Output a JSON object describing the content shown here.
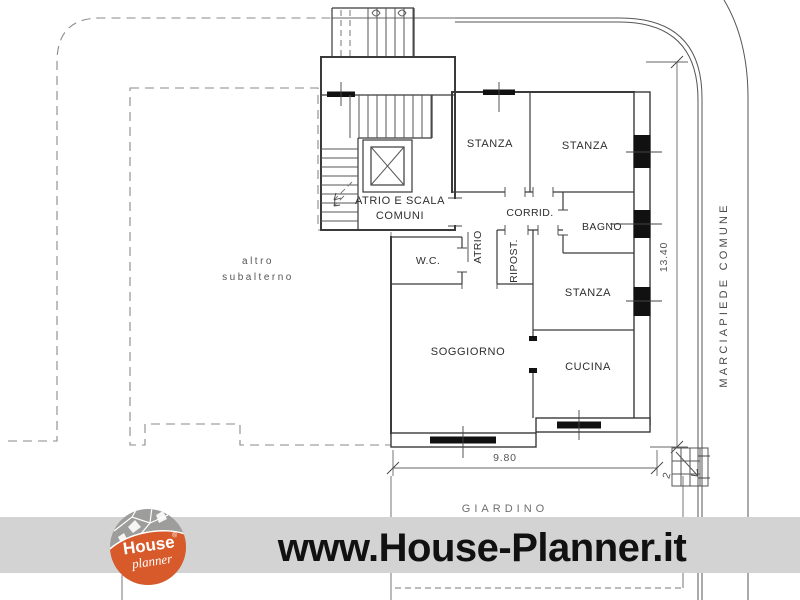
{
  "plan": {
    "room_labels": {
      "atrio_scala_line1": "ATRIO E SCALA",
      "atrio_scala_line2": "COMUNI",
      "stanza_nw": "STANZA",
      "stanza_ne": "STANZA",
      "corridoio": "CORRID.",
      "bagno": "BAGNO",
      "atrio": "ATRIO",
      "ripostiglio": "RIPOST.",
      "wc": "W.C.",
      "stanza_e": "STANZA",
      "soggiorno": "SOGGIORNO",
      "cucina": "CUCINA"
    },
    "area_labels": {
      "altro_line1": "altro",
      "altro_line2": "subalterno",
      "giardino": "GIARDINO",
      "marciapiede": "MARCIAPIEDE COMUNE"
    },
    "dimensions": {
      "vertical": "13.40",
      "horizontal": "9.80",
      "steps": "2"
    }
  },
  "footer": {
    "url": "www.House-Planner.it",
    "logo_line1": "House",
    "logo_line2": "planner",
    "logo_registered": "®"
  },
  "colors": {
    "line": "#3a3a3a",
    "boundary": "#8a8a8a",
    "hatch": "#9a9a9a",
    "footer_bar": "#d3d3d3",
    "logo_orange": "#d85a2b",
    "logo_gray": "#9d9d9b",
    "ink": "#111111"
  }
}
